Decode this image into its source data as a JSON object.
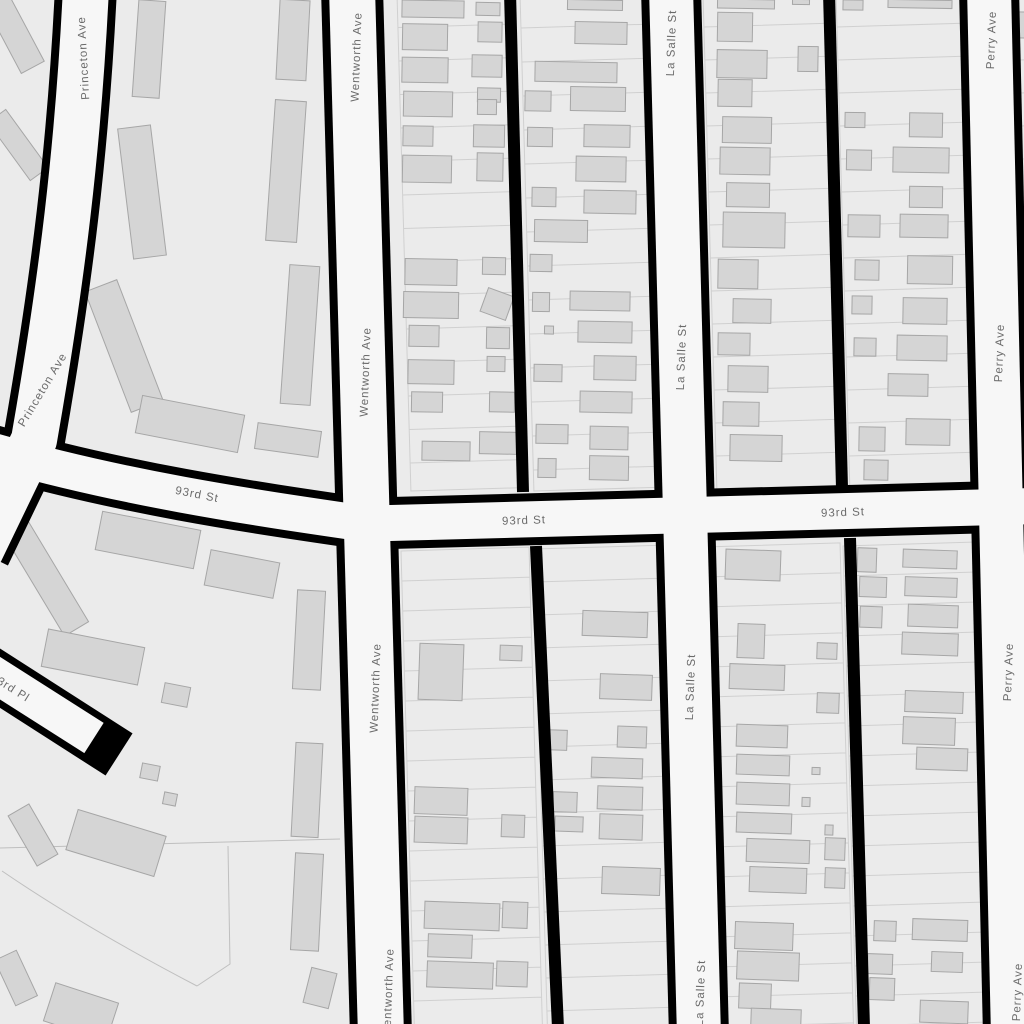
{
  "map_data": {
    "colors": {
      "background": "#ebebeb",
      "road_fill": "#f7f7f7",
      "road_casing": "#000000",
      "alley": "#000000",
      "building_fill": "#d5d5d5",
      "building_stroke": "#a6a6a6",
      "parcel_line": "#d0d0d0",
      "boundary_line": "#bfbfbf",
      "label_text": "#6a6a6a",
      "label_halo": "#f7f7f7"
    },
    "street_labels": [
      {
        "text": "Princeton Ave",
        "x": 84,
        "y": 58,
        "rot": -93
      },
      {
        "text": "Princeton Ave",
        "x": 43,
        "y": 390,
        "rot": -59
      },
      {
        "text": "Wentworth Ave",
        "x": 357,
        "y": 57,
        "rot": -88
      },
      {
        "text": "Wentworth Ave",
        "x": 366,
        "y": 372,
        "rot": -88
      },
      {
        "text": "Wentworth Ave",
        "x": 376,
        "y": 688,
        "rot": -88
      },
      {
        "text": "Wentworth Ave",
        "x": 389,
        "y": 993,
        "rot": -88
      },
      {
        "text": "La Salle St",
        "x": 672,
        "y": 43,
        "rot": -88
      },
      {
        "text": "La Salle St",
        "x": 682,
        "y": 357,
        "rot": -88
      },
      {
        "text": "La Salle St",
        "x": 691,
        "y": 687,
        "rot": -88
      },
      {
        "text": "La Salle St",
        "x": 701,
        "y": 993,
        "rot": -88
      },
      {
        "text": "Perry Ave",
        "x": 992,
        "y": 40,
        "rot": -88
      },
      {
        "text": "Perry Ave",
        "x": 1000,
        "y": 353,
        "rot": -88
      },
      {
        "text": "Perry Ave",
        "x": 1009,
        "y": 672,
        "rot": -88
      },
      {
        "text": "Perry Ave",
        "x": 1018,
        "y": 992,
        "rot": -88
      },
      {
        "text": "93rd St",
        "x": 197,
        "y": 495,
        "rot": 11
      },
      {
        "text": "93rd St",
        "x": 524,
        "y": 521,
        "rot": -2
      },
      {
        "text": "93rd St",
        "x": 843,
        "y": 513,
        "rot": -2
      },
      {
        "text": "93rd Pl",
        "x": 10,
        "y": 688,
        "rot": 32
      }
    ],
    "streets": [
      {
        "name": "princeton-ave",
        "path": "M 86,-12 C 78,150 62,280 34,440 L -20,552",
        "fill_width": 46,
        "casing_width": 62,
        "cap": "butt"
      },
      {
        "name": "wentworth-ave",
        "path": "M 352,-12 L 381,1036",
        "fill_width": 46,
        "casing_width": 62,
        "cap": "butt"
      },
      {
        "name": "la-salle-st",
        "path": "M 671,-12 L 699,1036",
        "fill_width": 44,
        "casing_width": 60,
        "cap": "butt"
      },
      {
        "name": "perry-ave",
        "path": "M 989,-12 L 1013,1036",
        "fill_width": 44,
        "casing_width": 60,
        "cap": "butt"
      },
      {
        "name": "93rd-st-main",
        "path": "M 352,524 L 1036,506",
        "fill_width": 36,
        "casing_width": 52,
        "cap": "butt"
      },
      {
        "name": "93rd-st-west",
        "path": "M 360,523 C 250,507 120,488 -14,449",
        "fill_width": 36,
        "casing_width": 52,
        "cap": "butt"
      },
      {
        "name": "93rd-pl",
        "path": "M -16,668 L 98,741",
        "fill_path": "M -16,668 L 94,738",
        "fill_width": 36,
        "casing_width": 50,
        "cap": "square"
      }
    ],
    "alleys": [
      {
        "name": "alley-wentworth-lasalle-north",
        "path": "M 510,-8 L 523,492",
        "width": 12
      },
      {
        "name": "alley-wentworth-lasalle-south",
        "path": "M 536,546 L 558,1028",
        "width": 12
      },
      {
        "name": "alley-lasalle-perry-north",
        "path": "M 829,-8 L 842,488",
        "width": 12
      },
      {
        "name": "alley-lasalle-perry-south",
        "path": "M 850,538 L 864,1028",
        "width": 12
      }
    ],
    "parcel_columns": [
      {
        "x0": 397,
        "w": 111,
        "y0": -6,
        "y1": 491,
        "step": 33.5
      },
      {
        "x0": 520,
        "w": 126,
        "y0": -6,
        "y1": 491,
        "step": 34
      },
      {
        "x0": 703,
        "w": 124,
        "y0": -6,
        "y1": 489,
        "step": 33
      },
      {
        "x0": 836,
        "w": 138,
        "y0": -6,
        "y1": 489,
        "step": 33
      },
      {
        "x0": 1018,
        "w": 30,
        "y0": -6,
        "y1": 486,
        "step": 33
      },
      {
        "x0": 401,
        "w": 128,
        "y0": 551,
        "y1": 1030,
        "step": 30
      },
      {
        "x0": 534,
        "w": 130,
        "y0": 549,
        "y1": 1030,
        "step": 33
      },
      {
        "x0": 704,
        "w": 136,
        "y0": 547,
        "y1": 1030,
        "step": 30
      },
      {
        "x0": 843,
        "w": 133,
        "y0": 546,
        "y1": 1030,
        "step": 30
      }
    ],
    "lean": 0.028,
    "row_slope": -0.03,
    "boundaries": [
      "M 0,848 L 340,839",
      "M 228,846 L 230,964 L 197,986",
      "M 2,871 C 62,912 132,952 197,986"
    ],
    "buildings": [
      [
        14,
        32,
        26,
        80,
        -28
      ],
      [
        18,
        145,
        22,
        72,
        -36
      ],
      [
        8,
        465,
        20,
        72,
        -30
      ],
      [
        149,
        49,
        27,
        97,
        4
      ],
      [
        142,
        192,
        33,
        131,
        -7
      ],
      [
        124,
        346,
        34,
        129,
        -21
      ],
      [
        190,
        424,
        104,
        38,
        11
      ],
      [
        288,
        440,
        64,
        26,
        8
      ],
      [
        293,
        40,
        30,
        80,
        3
      ],
      [
        286,
        171,
        31,
        141,
        4
      ],
      [
        300,
        335,
        30,
        139,
        4
      ],
      [
        433,
        9,
        62,
        17,
        1
      ],
      [
        488,
        9,
        24,
        13,
        1
      ],
      [
        425,
        37,
        45,
        26,
        1
      ],
      [
        490,
        32,
        24,
        20,
        1
      ],
      [
        425,
        70,
        46,
        25,
        1
      ],
      [
        487,
        66,
        30,
        22,
        1
      ],
      [
        428,
        104,
        49,
        25,
        1
      ],
      [
        489,
        95,
        23,
        14,
        1
      ],
      [
        487,
        107,
        19,
        15,
        1
      ],
      [
        418,
        136,
        30,
        20,
        1
      ],
      [
        489,
        136,
        31,
        22,
        1
      ],
      [
        427,
        169,
        49,
        27,
        1
      ],
      [
        490,
        167,
        26,
        28,
        1
      ],
      [
        431,
        272,
        52,
        26,
        1
      ],
      [
        494,
        266,
        23,
        17,
        1
      ],
      [
        431,
        305,
        55,
        26,
        1
      ],
      [
        497,
        304,
        27,
        25,
        20
      ],
      [
        424,
        336,
        30,
        21,
        1
      ],
      [
        498,
        338,
        23,
        21,
        1
      ],
      [
        431,
        372,
        46,
        24,
        1
      ],
      [
        496,
        364,
        18,
        15,
        1
      ],
      [
        427,
        402,
        31,
        20,
        1
      ],
      [
        502,
        402,
        25,
        20,
        1
      ],
      [
        446,
        451,
        48,
        19,
        1
      ],
      [
        498,
        443,
        37,
        22,
        1
      ],
      [
        595,
        5,
        55,
        10,
        1
      ],
      [
        601,
        33,
        52,
        22,
        1
      ],
      [
        576,
        72,
        82,
        20,
        1
      ],
      [
        538,
        101,
        26,
        20,
        1
      ],
      [
        598,
        99,
        55,
        24,
        1
      ],
      [
        540,
        137,
        25,
        19,
        1
      ],
      [
        607,
        136,
        46,
        22,
        1
      ],
      [
        601,
        169,
        50,
        25,
        1
      ],
      [
        544,
        197,
        24,
        19,
        1
      ],
      [
        610,
        202,
        52,
        23,
        1
      ],
      [
        561,
        231,
        53,
        22,
        1
      ],
      [
        541,
        263,
        22,
        17,
        1
      ],
      [
        541,
        302,
        17,
        19,
        1
      ],
      [
        600,
        301,
        60,
        19,
        1
      ],
      [
        549,
        330,
        9,
        8,
        1
      ],
      [
        605,
        332,
        54,
        21,
        1
      ],
      [
        548,
        373,
        28,
        17,
        1
      ],
      [
        615,
        368,
        42,
        24,
        1
      ],
      [
        606,
        402,
        52,
        21,
        1
      ],
      [
        552,
        434,
        32,
        19,
        1
      ],
      [
        609,
        438,
        38,
        23,
        1
      ],
      [
        547,
        468,
        18,
        19,
        1
      ],
      [
        609,
        468,
        39,
        24,
        1
      ],
      [
        746,
        4,
        57,
        9,
        1
      ],
      [
        801,
        2,
        17,
        5,
        1
      ],
      [
        735,
        27,
        35,
        29,
        1
      ],
      [
        742,
        64,
        50,
        28,
        1
      ],
      [
        808,
        59,
        20,
        25,
        1
      ],
      [
        735,
        93,
        34,
        27,
        1
      ],
      [
        747,
        130,
        49,
        26,
        1
      ],
      [
        745,
        161,
        50,
        27,
        1
      ],
      [
        748,
        195,
        43,
        24,
        1
      ],
      [
        754,
        230,
        62,
        35,
        1
      ],
      [
        738,
        274,
        40,
        29,
        1
      ],
      [
        752,
        311,
        38,
        24,
        1
      ],
      [
        734,
        344,
        32,
        22,
        1
      ],
      [
        748,
        379,
        40,
        26,
        1
      ],
      [
        741,
        414,
        36,
        24,
        1
      ],
      [
        756,
        448,
        52,
        26,
        1
      ],
      [
        853,
        5,
        20,
        10,
        1
      ],
      [
        920,
        4,
        64,
        8,
        1
      ],
      [
        855,
        120,
        20,
        15,
        1
      ],
      [
        926,
        125,
        33,
        24,
        1
      ],
      [
        859,
        160,
        25,
        20,
        1
      ],
      [
        921,
        160,
        56,
        25,
        1
      ],
      [
        926,
        197,
        33,
        21,
        1
      ],
      [
        864,
        226,
        32,
        22,
        1
      ],
      [
        924,
        226,
        48,
        23,
        1
      ],
      [
        867,
        270,
        24,
        20,
        1
      ],
      [
        930,
        270,
        45,
        28,
        1
      ],
      [
        862,
        305,
        20,
        18,
        1
      ],
      [
        925,
        311,
        44,
        26,
        1
      ],
      [
        865,
        347,
        22,
        18,
        1
      ],
      [
        922,
        348,
        50,
        25,
        1
      ],
      [
        908,
        385,
        40,
        22,
        1
      ],
      [
        872,
        439,
        26,
        24,
        1
      ],
      [
        928,
        432,
        44,
        26,
        1
      ],
      [
        876,
        470,
        24,
        20,
        1
      ],
      [
        1021,
        25,
        10,
        26,
        1
      ],
      [
        40,
        568,
        28,
        142,
        -31
      ],
      [
        148,
        540,
        100,
        39,
        11
      ],
      [
        242,
        574,
        70,
        36,
        11
      ],
      [
        309,
        640,
        28,
        99,
        3
      ],
      [
        93,
        657,
        98,
        38,
        11
      ],
      [
        176,
        695,
        26,
        20,
        11
      ],
      [
        150,
        772,
        18,
        15,
        11
      ],
      [
        170,
        799,
        13,
        12,
        11
      ],
      [
        307,
        790,
        27,
        94,
        3
      ],
      [
        33,
        835,
        24,
        58,
        -30
      ],
      [
        116,
        843,
        92,
        42,
        17
      ],
      [
        307,
        902,
        28,
        97,
        3
      ],
      [
        320,
        988,
        26,
        36,
        14
      ],
      [
        81,
        1012,
        66,
        40,
        18
      ],
      [
        16,
        978,
        24,
        50,
        -25
      ],
      [
        441,
        672,
        44,
        56,
        2
      ],
      [
        511,
        653,
        22,
        15,
        2
      ],
      [
        441,
        801,
        53,
        27,
        2
      ],
      [
        441,
        830,
        53,
        26,
        2
      ],
      [
        513,
        826,
        23,
        22,
        2
      ],
      [
        462,
        916,
        75,
        27,
        2
      ],
      [
        515,
        915,
        25,
        26,
        2
      ],
      [
        450,
        946,
        44,
        23,
        2
      ],
      [
        460,
        975,
        66,
        26,
        2
      ],
      [
        512,
        974,
        31,
        25,
        2
      ],
      [
        615,
        624,
        65,
        25,
        2
      ],
      [
        626,
        687,
        52,
        25,
        2
      ],
      [
        556,
        740,
        22,
        20,
        2
      ],
      [
        632,
        737,
        29,
        21,
        2
      ],
      [
        617,
        768,
        51,
        20,
        2
      ],
      [
        565,
        802,
        24,
        20,
        2
      ],
      [
        620,
        798,
        45,
        23,
        2
      ],
      [
        569,
        824,
        28,
        15,
        2
      ],
      [
        621,
        827,
        43,
        25,
        2
      ],
      [
        631,
        881,
        58,
        27,
        2
      ],
      [
        753,
        565,
        55,
        30,
        2
      ],
      [
        751,
        641,
        27,
        34,
        2
      ],
      [
        827,
        651,
        20,
        16,
        2
      ],
      [
        757,
        677,
        55,
        25,
        2
      ],
      [
        828,
        703,
        22,
        20,
        2
      ],
      [
        762,
        736,
        51,
        22,
        2
      ],
      [
        763,
        765,
        53,
        20,
        2
      ],
      [
        816,
        771,
        8,
        7,
        2
      ],
      [
        763,
        794,
        53,
        22,
        2
      ],
      [
        806,
        802,
        8,
        9,
        2
      ],
      [
        764,
        823,
        55,
        20,
        2
      ],
      [
        829,
        830,
        8,
        10,
        2
      ],
      [
        778,
        851,
        63,
        23,
        2
      ],
      [
        835,
        849,
        20,
        22,
        2
      ],
      [
        778,
        880,
        57,
        25,
        2
      ],
      [
        835,
        878,
        20,
        20,
        2
      ],
      [
        764,
        936,
        58,
        27,
        2
      ],
      [
        768,
        966,
        62,
        28,
        2
      ],
      [
        755,
        996,
        32,
        25,
        2
      ],
      [
        776,
        1018,
        50,
        18,
        2
      ],
      [
        867,
        560,
        19,
        24,
        2
      ],
      [
        930,
        559,
        54,
        18,
        2
      ],
      [
        873,
        587,
        27,
        20,
        2
      ],
      [
        931,
        587,
        52,
        19,
        2
      ],
      [
        871,
        617,
        22,
        21,
        2
      ],
      [
        933,
        616,
        50,
        22,
        2
      ],
      [
        930,
        644,
        56,
        22,
        2
      ],
      [
        934,
        702,
        58,
        21,
        2
      ],
      [
        929,
        731,
        52,
        27,
        2
      ],
      [
        942,
        759,
        51,
        22,
        2
      ],
      [
        885,
        931,
        22,
        20,
        2
      ],
      [
        940,
        930,
        55,
        21,
        2
      ],
      [
        880,
        964,
        25,
        20,
        2
      ],
      [
        947,
        962,
        31,
        20,
        2
      ],
      [
        882,
        989,
        25,
        22,
        2
      ],
      [
        944,
        1012,
        48,
        22,
        2
      ]
    ]
  }
}
